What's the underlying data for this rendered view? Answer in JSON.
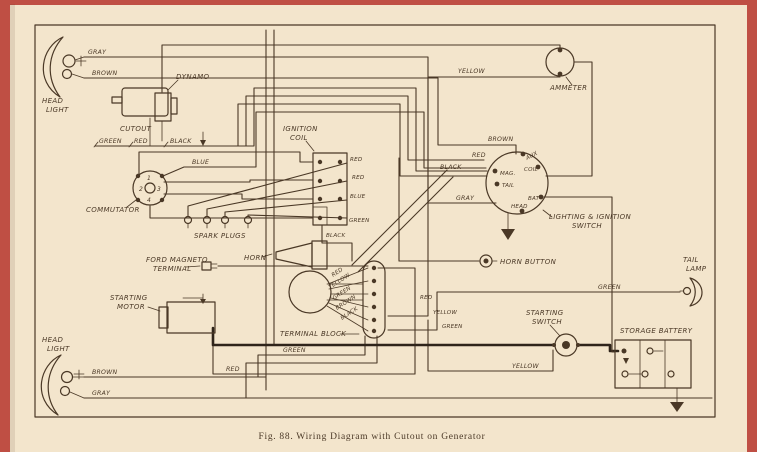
{
  "figure_caption": "Fig. 88.  Wiring Diagram with Cutout on Generator",
  "colors": {
    "paper": "#f3e5cc",
    "ink": "#4a3826",
    "page_edge": "#bf4f44",
    "heavy_wire": "#2f241a"
  },
  "components": {
    "head_light_top": {
      "line1": "HEAD",
      "line2": "LIGHT"
    },
    "dynamo": "DYNAMO",
    "cutout": "CUTOUT",
    "commutator": "COMMUTATOR",
    "commutator_points": [
      "1",
      "2",
      "3",
      "4"
    ],
    "ignition_coil": {
      "line1": "IGNITION",
      "line2": "COIL"
    },
    "spark_plugs": "SPARK PLUGS",
    "horn": "HORN",
    "horn_button": "HORN BUTTON",
    "ammeter": "AMMETER",
    "lighting_ignition_switch": {
      "line1": "LIGHTING & IGNITION",
      "line2": "SWITCH"
    },
    "switch_terminals": {
      "aux": "AUX",
      "mag": "MAG.",
      "tail": "TAIL",
      "coil": "COIL",
      "bat": "BAT",
      "head": "HEAD"
    },
    "ford_magneto_terminal": {
      "line1": "FORD MAGNETO",
      "line2": "TERMINAL"
    },
    "starting_motor": {
      "line1": "STARTING",
      "line2": "MOTOR"
    },
    "terminal_block": "TERMINAL BLOCK",
    "starting_switch": {
      "line1": "STARTING",
      "line2": "SWITCH"
    },
    "storage_battery": "STORAGE BATTERY",
    "tail_lamp": {
      "line1": "TAIL",
      "line2": "LAMP"
    },
    "head_light_bottom": {
      "line1": "HEAD",
      "line2": "LIGHT"
    }
  },
  "wire_labels": {
    "headlight_top_gray": "GRAY",
    "headlight_top_brown": "BROWN",
    "cutout_green": "GREEN",
    "cutout_red": "RED",
    "cutout_black": "BLACK",
    "commutator_blue": "BLUE",
    "coil_red_1": "RED",
    "coil_red_2": "RED",
    "coil_blue": "BLUE",
    "coil_green": "GREEN",
    "coil_black": "BLACK",
    "ammeter_yellow": "YELLOW",
    "switch_brown": "BROWN",
    "switch_red": "RED",
    "switch_black": "BLACK",
    "switch_gray": "GRAY",
    "block_red": "RED",
    "block_yellow": "YELLOW",
    "block_green": "GREEN",
    "block_brown": "BROWN",
    "block_black": "BLACK",
    "block_right_red": "RED",
    "block_right_yellow": "YELLOW",
    "block_right_green": "GREEN",
    "tail_green": "GREEN",
    "starting_yellow": "YELLOW",
    "bottom_green": "GREEN",
    "bottom_red": "RED",
    "headlight_bottom_brown": "BROWN",
    "headlight_bottom_gray": "GRAY"
  }
}
